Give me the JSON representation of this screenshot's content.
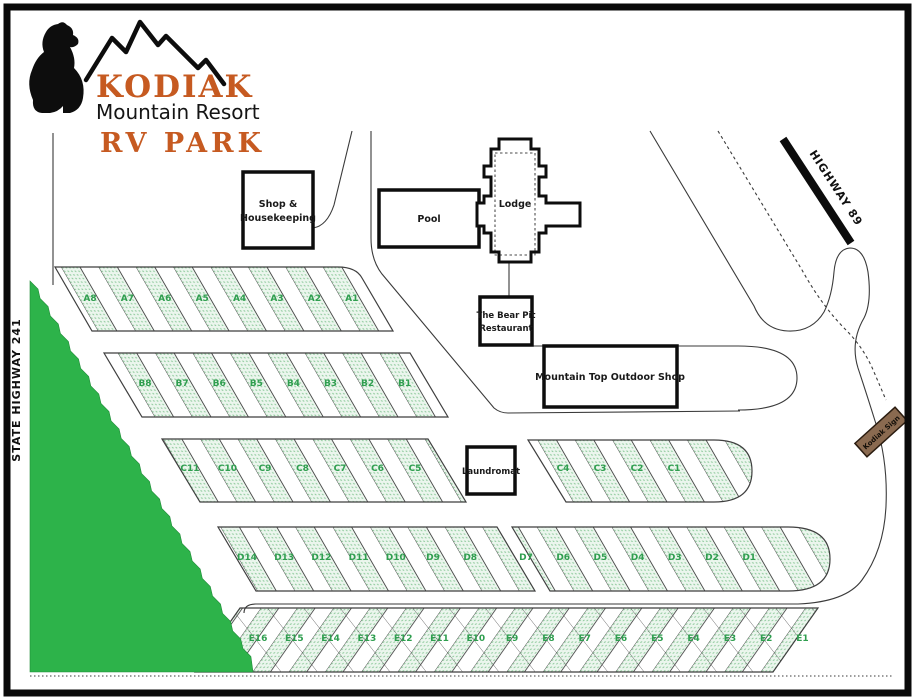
{
  "logo": {
    "title": "KODIAK",
    "subtitle": "Mountain Resort",
    "subtitle2": "RV PARK"
  },
  "roads": {
    "left_highway": "STATE HIGHWAY 241",
    "top_highway": "HIGHWAY 89",
    "sign": "Kodiak Sign"
  },
  "buildings": {
    "shop_line1": "Shop &",
    "shop_line2": "Housekeeping",
    "pool": "Pool",
    "lodge": "Lodge",
    "restaurant_line1": "The Bear Pit",
    "restaurant_line2": "Restaurant",
    "outdoor_shop": "Mountain Top Outdoor Shop",
    "laundromat": "Laundromat"
  },
  "sites": {
    "row_a": [
      "A8",
      "A7",
      "A6",
      "A5",
      "A4",
      "A3",
      "A2",
      "A1"
    ],
    "row_b": [
      "B8",
      "B7",
      "B6",
      "B5",
      "B4",
      "B3",
      "B2",
      "B1"
    ],
    "row_c_left": [
      "C11",
      "C10",
      "C9",
      "C8",
      "C7",
      "C6",
      "C5"
    ],
    "row_c_right": [
      "C4",
      "C3",
      "C2",
      "C1"
    ],
    "row_d_left": [
      "D14",
      "D13",
      "D12",
      "D11",
      "D10",
      "D9",
      "D8"
    ],
    "row_d_right": [
      "D7",
      "D6",
      "D5",
      "D4",
      "D3",
      "D2",
      "D1"
    ],
    "row_e": [
      "E16",
      "E15",
      "E14",
      "E13",
      "E12",
      "E11",
      "E10",
      "E9",
      "E8",
      "E7",
      "E6",
      "E5",
      "E4",
      "E3",
      "E2",
      "E1"
    ]
  },
  "colors": {
    "accent_orange": "#c65a21",
    "site_label_green": "#2f9e4f",
    "forest_green": "#2db34a",
    "stipple_green": "#8cc99a",
    "sign_brown": "#8a6a50"
  }
}
